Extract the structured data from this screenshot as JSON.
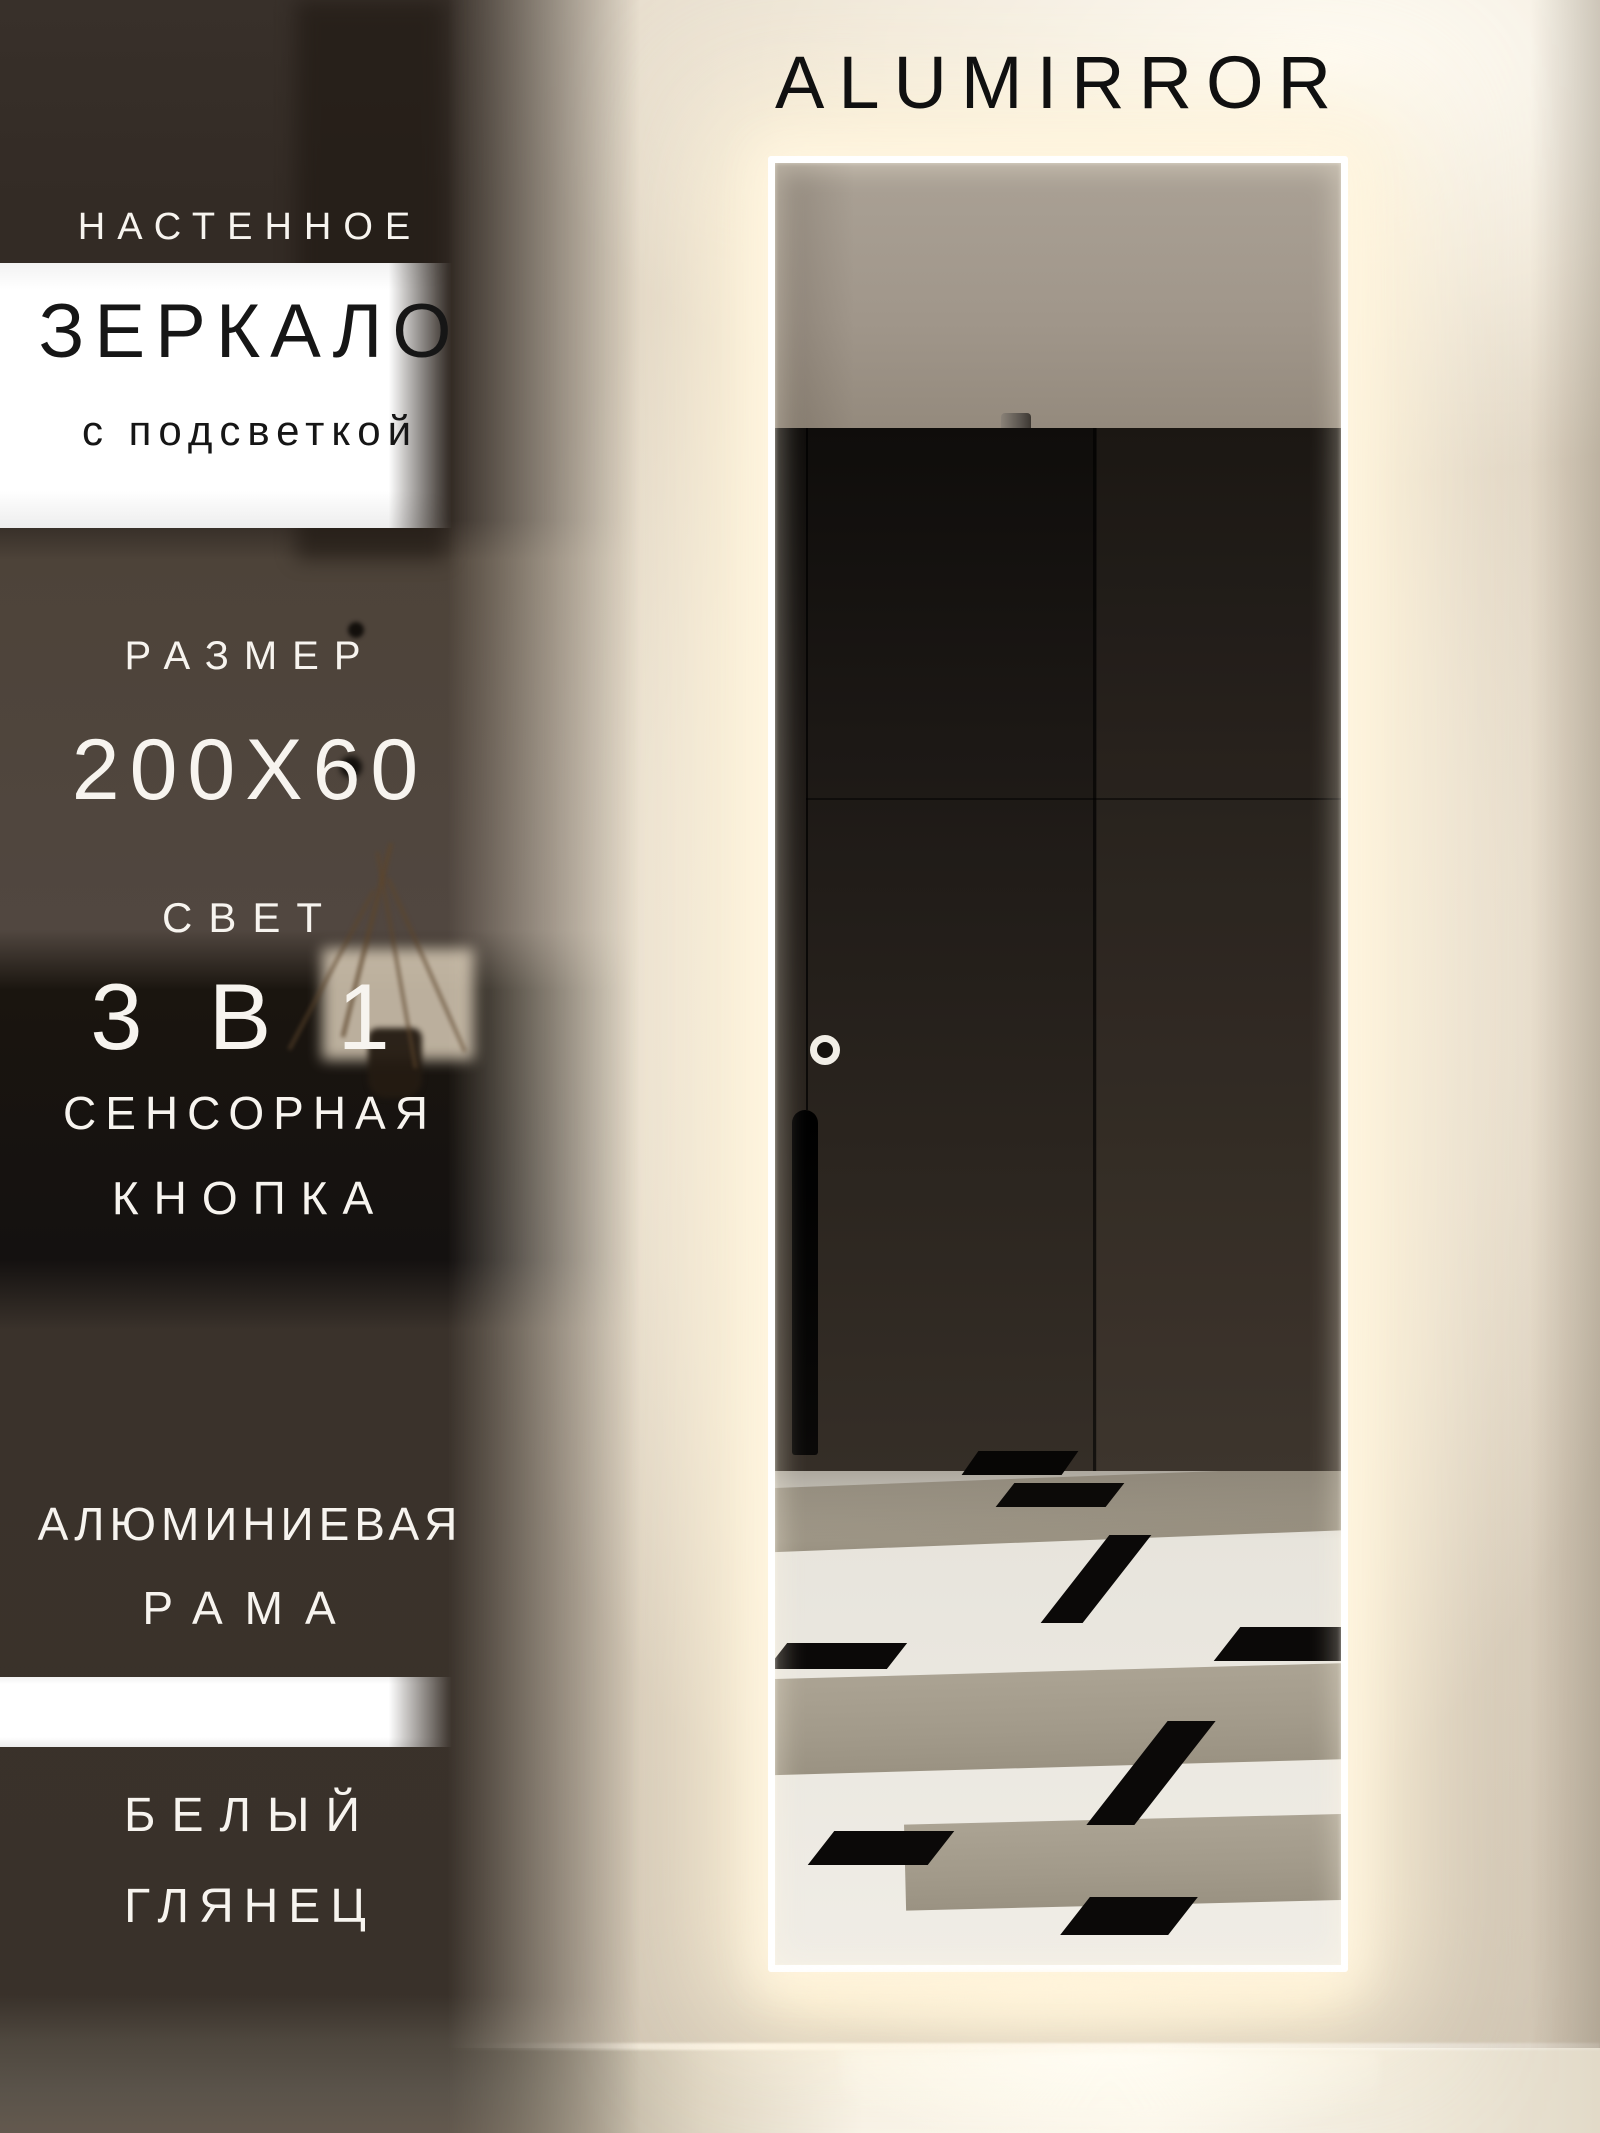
{
  "brand": {
    "name": "ALUMIRROR"
  },
  "overlay": {
    "wall_type": "НАСТЕННОЕ",
    "product": "ЗЕРКАЛО",
    "product_qualifier": "с подсветкой",
    "size_label": "РАЗМЕР",
    "size_value": "200X60",
    "light_label": "СВЕТ",
    "light_value": "3 В 1",
    "touch_line1": "СЕНСОРНАЯ",
    "touch_line2": "КНОПКА",
    "frame_line1": "АЛЮМИНИЕВАЯ",
    "frame_line2": "РАМА",
    "finish_line1": "БЕЛЫЙ",
    "finish_line2": "ГЛЯНЕЦ"
  },
  "colors": {
    "backlight_glow": "#fff3da",
    "wall_beige": "#dcd1c0",
    "dark_wall": "#332b25",
    "band_white": "#ffffff",
    "text_light": "#f7f4ef",
    "text_dark": "#161616",
    "mirror_frame": "#ffffff"
  }
}
